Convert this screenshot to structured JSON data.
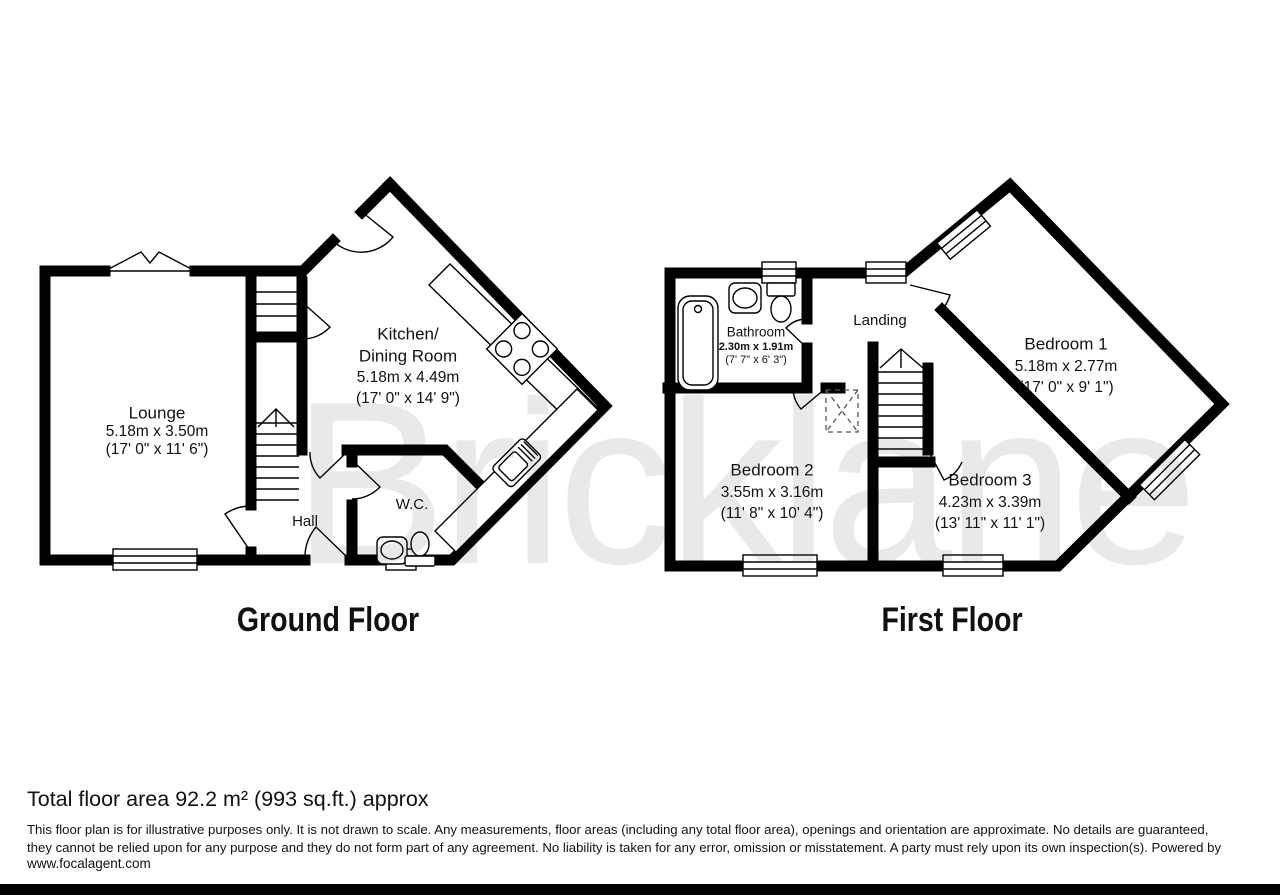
{
  "watermark": "Bricklane",
  "colors": {
    "walls": "#000000",
    "watermark": "#e9e9e9",
    "background": "#ffffff"
  },
  "ground_floor": {
    "title": "Ground Floor",
    "rooms": {
      "lounge": {
        "name": "Lounge",
        "metric": "5.18m x 3.50m",
        "imperial": "(17' 0\" x 11' 6\")"
      },
      "kitchen": {
        "name_line1": "Kitchen/",
        "name_line2": "Dining Room",
        "metric": "5.18m x 4.49m",
        "imperial": "(17' 0\" x 14' 9\")"
      },
      "hall": {
        "name": "Hall"
      },
      "wc": {
        "name": "W.C."
      }
    }
  },
  "first_floor": {
    "title": "First Floor",
    "rooms": {
      "bathroom": {
        "name": "Bathroom",
        "metric": "2.30m x 1.91m",
        "imperial": "(7' 7\" x 6' 3\")"
      },
      "landing": {
        "name": "Landing"
      },
      "bedroom1": {
        "name": "Bedroom 1",
        "metric": "5.18m x 2.77m",
        "imperial": "(17' 0\" x 9' 1\")"
      },
      "bedroom2": {
        "name": "Bedroom 2",
        "metric": "3.55m x 3.16m",
        "imperial": "(11' 8\" x 10' 4\")"
      },
      "bedroom3": {
        "name": "Bedroom 3",
        "metric": "4.23m x 3.39m",
        "imperial": "(13' 11\" x 11' 1\")"
      }
    }
  },
  "footer": {
    "total_area": "Total floor area 92.2 m² (993 sq.ft.) approx",
    "disclaimer_line1": "This floor plan is for illustrative purposes only. It is not drawn to scale. Any measurements, floor areas (including any total floor area), openings and orientation are approximate. No details are guaranteed,",
    "disclaimer_line2": "they cannot be relied upon for any purpose and they do not form part of any agreement. No liability is taken for any error, omission or misstatement. A party must rely upon its own inspection(s). Powered by",
    "website": "www.focalagent.com"
  }
}
